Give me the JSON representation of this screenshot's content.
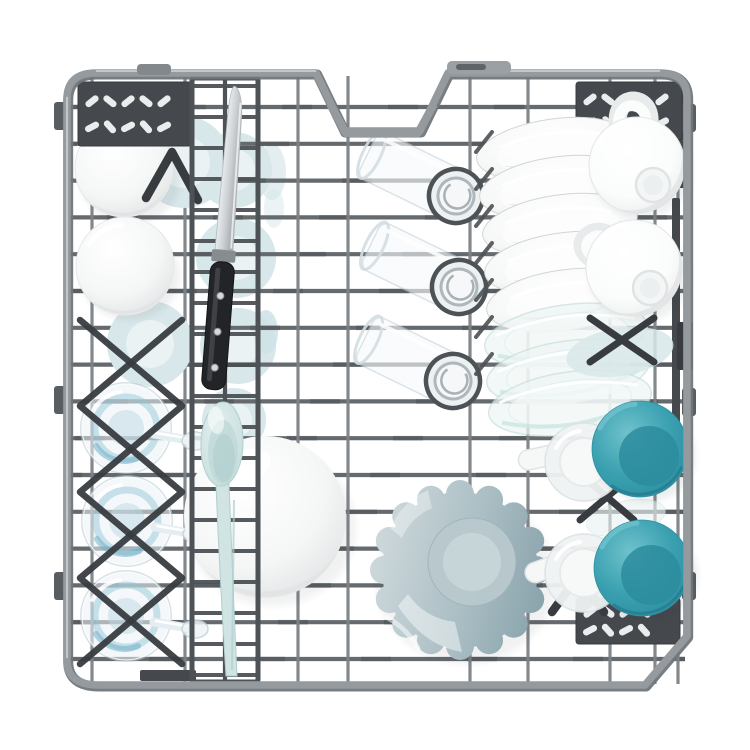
{
  "scene": {
    "subject": "Top-down view of an open dishwasher rack fully loaded with clean dishes",
    "background": "#ffffff"
  },
  "palette": {
    "bg": "#ffffff",
    "frame": "#949a9e",
    "frame_hi": "#c7ccce",
    "wire": "#656a6e",
    "wire_light": "#7d8286",
    "wire_dark": "#4d5256",
    "plastic": "#45494d",
    "plastic_dark": "#383c40",
    "dish_white": "#ffffff",
    "dish_shade": "#dfe2e3",
    "pale_blue": "#d8e7ea",
    "pale_blue_hi": "#eaf2f4",
    "mint": "#cfe4e3",
    "mint_deep": "#aecfce",
    "teal": "#3aa0b0",
    "teal_deep": "#2b8c9e",
    "teal_light": "#6fc2cc",
    "glass": "#eef4f6",
    "glass_edge": "#b7c9d0",
    "water": "#8fc3d4",
    "water_deep": "#68aac3",
    "blade_light": "#f3f5f6",
    "blade_dark": "#a7acb0",
    "handle_black": "#232427",
    "scallop_light": "#ccd7da",
    "scallop_mid": "#aabec4",
    "scallop_deep": "#8aa3ac",
    "slot_hole": "#f4f5f5"
  },
  "inventory": {
    "white_bowls": 2,
    "wine_glasses": 3,
    "glass_tumblers": 3,
    "white_plates": 5,
    "glass_plates": 3,
    "white_mugs": 2,
    "teal_cups": 2,
    "frosted_cups": 2,
    "pale_blue_plates": 4,
    "large_white_bowl": 1,
    "scalloped_bowl": 1,
    "utensils": [
      "knife",
      "serving-spoon"
    ],
    "rack_features": [
      "wire-grid",
      "cutlery-basket",
      "fold-down-shelves",
      "stemware-lattice",
      "plate-tines"
    ]
  }
}
